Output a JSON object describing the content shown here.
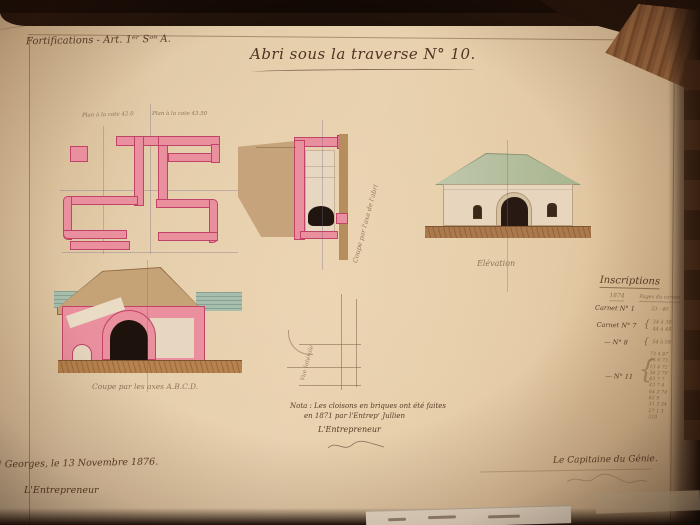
{
  "header": {
    "classification": "Fortifications - Art. 1ᵉʳ Sᵒⁿ A.",
    "page_number": "19"
  },
  "title": {
    "text": "Abri sous la traverse N° 10."
  },
  "drawings": {
    "plan": {
      "label_left": "Plan à la cote 42.0",
      "label_right": "Plan à la cote 43.50"
    },
    "axis_section": {
      "caption": "Coupe par l'axe de l'abri"
    },
    "elevation": {
      "caption": "Élévation"
    },
    "cross_section": {
      "caption": "Coupe par les axes A.B.C.D."
    },
    "side_view": {
      "caption": "Vue latérale"
    }
  },
  "nota": {
    "line1": "Nota : Les cloisons en briques ont été faites",
    "line2": "en 1871 par l'Entrepʳ Jullien",
    "signoff": "L'Entrepreneur"
  },
  "inscriptions": {
    "title": "Inscriptions",
    "col_year": "1874",
    "col_pages": "Pages du carnet",
    "rows": [
      {
        "label": "Carnet N° 1",
        "values": "33 · 40"
      },
      {
        "label": "Carnet N° 7",
        "values2a": "34 à 38",
        "values2b": "44 à 48"
      },
      {
        "label": "—  N° 8",
        "values": "54 à 58"
      },
      {
        "label": "—  N° 11",
        "values": ""
      }
    ],
    "numbers": [
      "73 4 87",
      "34 6 73",
      "13 4 72",
      "36 2 79",
      "83 7 7",
      "43 7 4",
      "64 3 74",
      "82 9",
      "31 3 34",
      "27 1 3",
      "210"
    ]
  },
  "footer": {
    "place_date": "…ᵗ Georges, le 13 Novembre 1876.",
    "entrepreneur": "L'Entrepreneur",
    "captain": "Le Capitaine du Génie."
  },
  "colors": {
    "paper": "#edd9b6",
    "ink": "#553c26",
    "masonry_pink": "#ef93a4",
    "masonry_outline": "#c2446a",
    "earth_tan": "#c9a87e",
    "roof_green": "#b4c3a4",
    "ground_brown": "#ac7c4c",
    "water_green": "#a8c4b4",
    "opening_black": "#1b130d"
  }
}
